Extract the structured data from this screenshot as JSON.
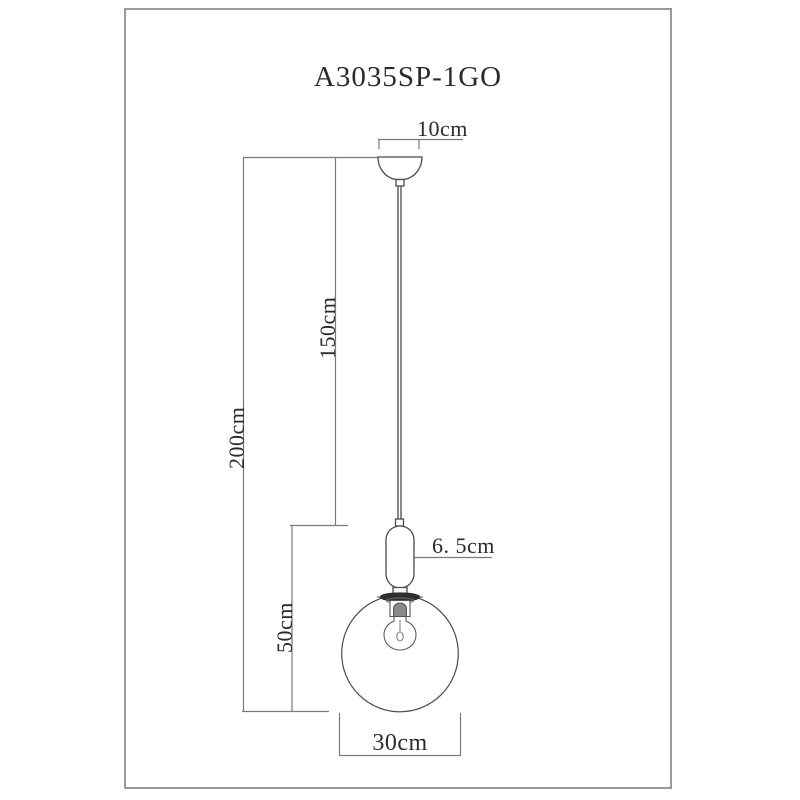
{
  "drawing": {
    "title": "A3035SP-1GO",
    "type": "pendant-lamp-dimension-diagram",
    "dimensions": {
      "canopy_width": "10cm",
      "cord_length": "150cm",
      "total_height": "200cm",
      "body_height": "50cm",
      "socket_diameter": "6. 5cm",
      "shade_diameter": "30cm"
    },
    "colors": {
      "background": "#ffffff",
      "frame_border": "#9a9a9a",
      "outline_line": "#4a4a4a",
      "dimension_line": "#7a7a7a",
      "text": "#2b2b2b",
      "flange_fill": "#2f2f2f",
      "bulb_base_fill": "#8a8a8a"
    }
  }
}
